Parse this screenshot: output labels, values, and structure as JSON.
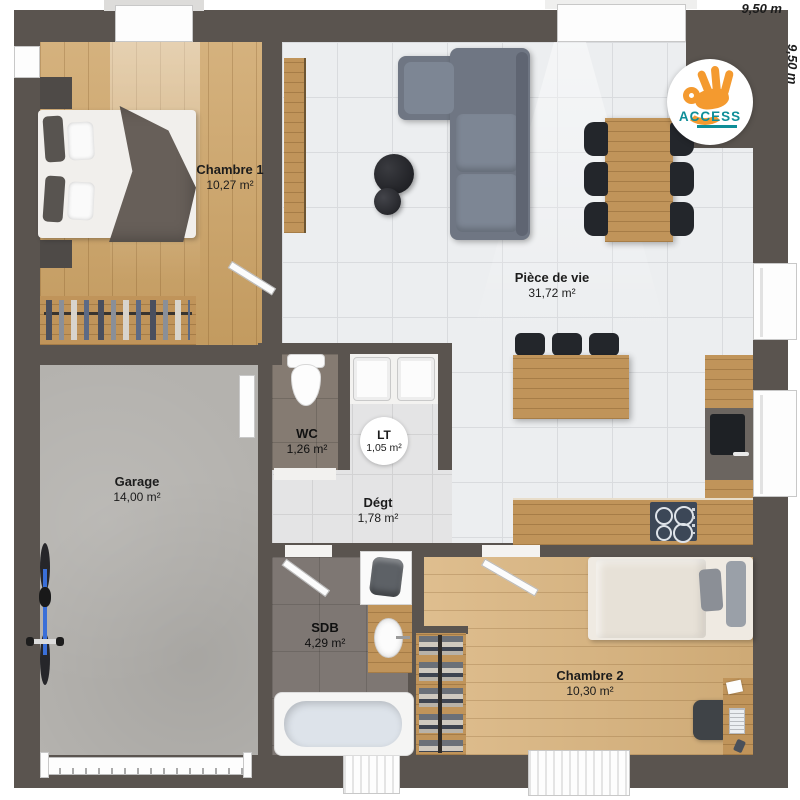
{
  "plan": {
    "dimension_top": "9,50 m",
    "dimension_right": "9,50 m"
  },
  "logo": {
    "brand": "ACCESS"
  },
  "rooms": {
    "chambre1": {
      "name": "Chambre 1",
      "area": "10,27 m²"
    },
    "piece_de_vie": {
      "name": "Pièce de vie",
      "area": "31,72 m²"
    },
    "garage": {
      "name": "Garage",
      "area": "14,00 m²"
    },
    "wc": {
      "name": "WC",
      "area": "1,26 m²"
    },
    "lt": {
      "name": "LT",
      "area": "1,05 m²"
    },
    "degt": {
      "name": "Dégt",
      "area": "1,78 m²"
    },
    "sdb": {
      "name": "SDB",
      "area": "4,29 m²"
    },
    "chambre2": {
      "name": "Chambre 2",
      "area": "10,30 m²"
    }
  },
  "colors": {
    "wall": "#5a544f",
    "wood": "#cda365",
    "tile": "#eceef0",
    "concrete": "#b4b2ae",
    "logo_orange": "#f49a2f",
    "logo_teal": "#0f8e98"
  }
}
